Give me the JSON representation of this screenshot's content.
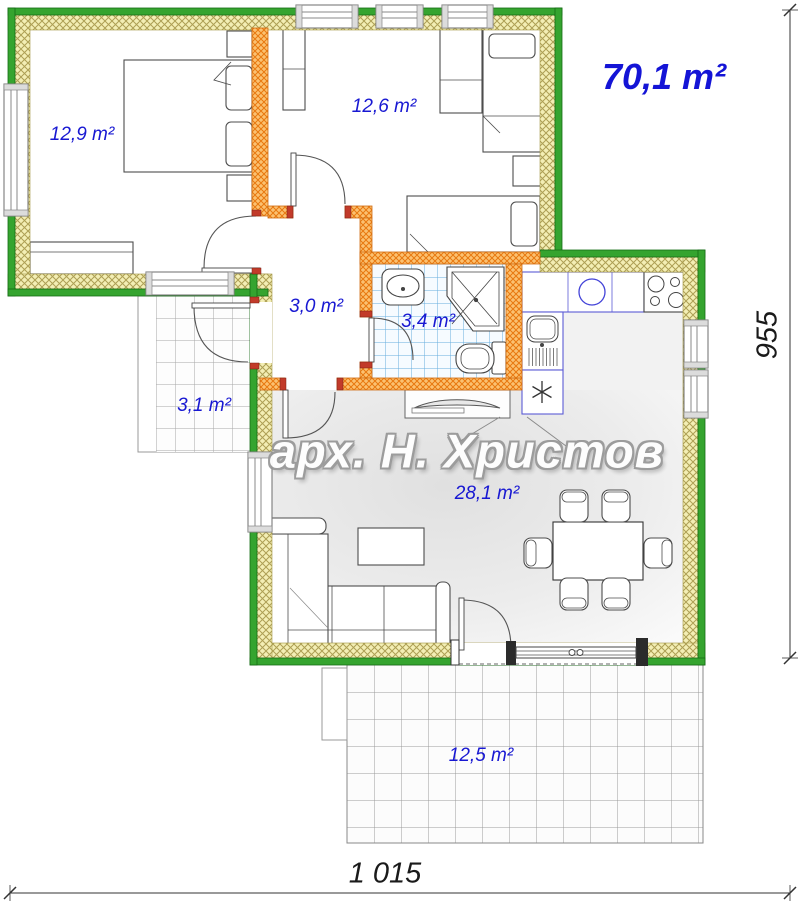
{
  "plan": {
    "total_area_label": "70,1 m²",
    "architect_watermark": "арх. Н. Христов",
    "rooms": {
      "bedroom1": "12,9 m²",
      "bedroom2": "12,6 m²",
      "hallway": "3,0 m²",
      "bathroom": "3,4 m²",
      "entry_porch": "3,1 m²",
      "living_kitchen": "28,1 m²",
      "terrace": "12,5 m²"
    },
    "dimensions": {
      "overall_width": "1 015",
      "overall_height": "955"
    },
    "colors": {
      "exterior_wall_green": "#35a42f",
      "insulation_yellow": "#f3eeb4",
      "interior_wall_orange": "#fbc171",
      "area_label_blue": "#1818d2",
      "bathroom_tile_blue": "#66aede"
    }
  }
}
